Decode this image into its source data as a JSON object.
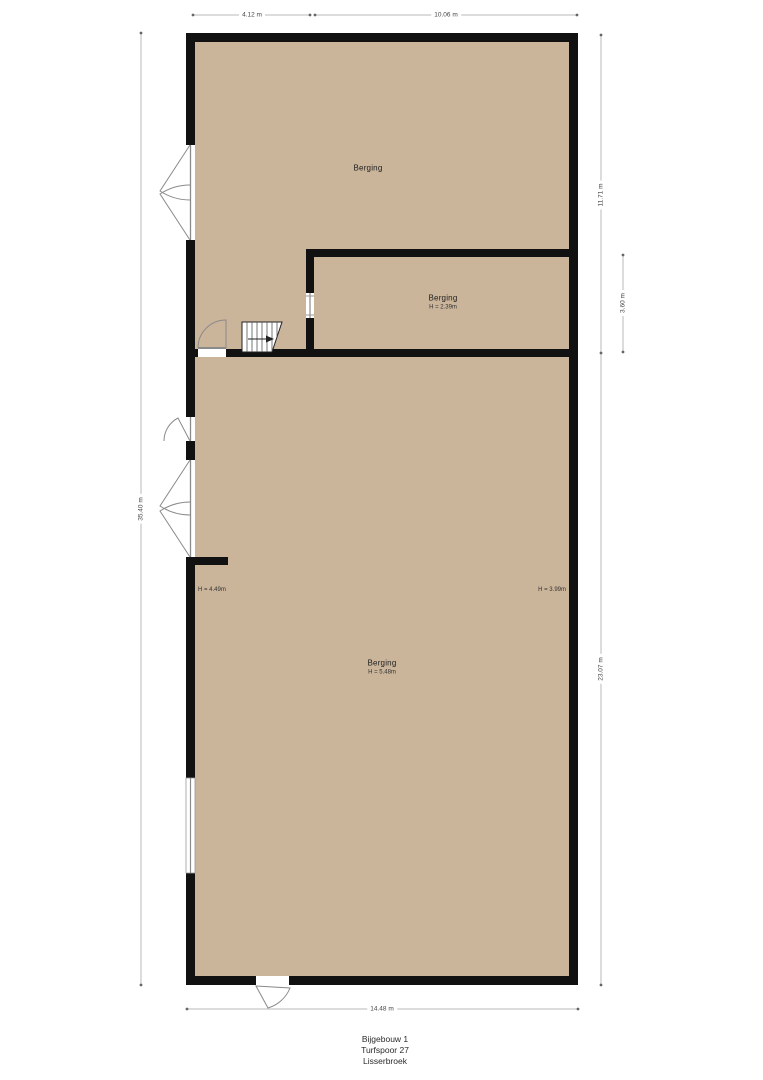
{
  "rooms": {
    "top": {
      "label": "Berging"
    },
    "middle": {
      "label": "Berging",
      "height": "H = 2.39m"
    },
    "main": {
      "label": "Berging",
      "height": "H = 5.48m"
    },
    "left_wall_height": "H = 4.49m",
    "right_wall_height": "H = 3.99m"
  },
  "dimensions": {
    "top_left": "4.12 m",
    "top_right": "10.06 m",
    "right_upper": "11.71 m",
    "right_middle": "3.60 m",
    "right_lower": "23.07 m",
    "left": "35.40 m",
    "bottom": "14.48 m"
  },
  "title_block": {
    "line1": "Bijgebouw 1",
    "line2": "Turfspoor 27",
    "line3": "Lisserbroek"
  },
  "colors": {
    "floor": "#cab49a",
    "wall": "#111111",
    "dim_line": "#b8b8b8",
    "dim_text": "#444444",
    "symbol": "#8a8a8a"
  }
}
